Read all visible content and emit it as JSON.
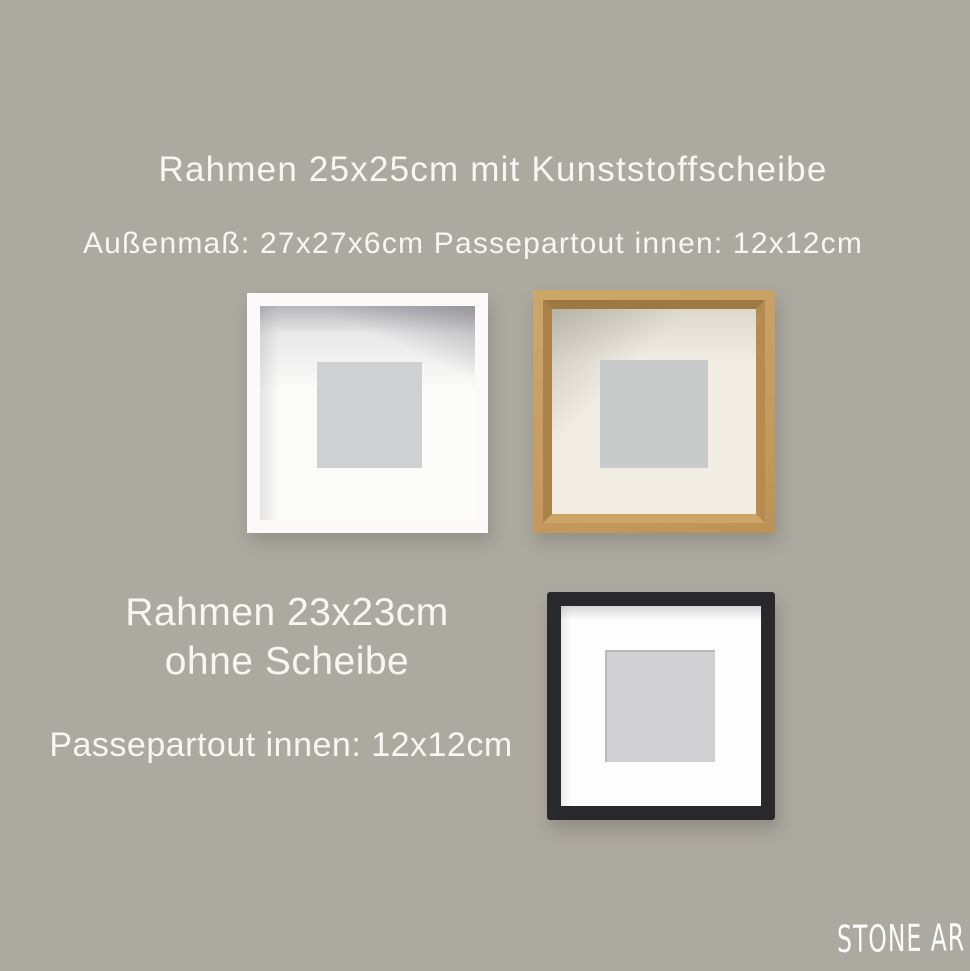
{
  "page": {
    "background_color": "#aca9a0",
    "text_color": "#f8f6f0"
  },
  "top_section": {
    "title": "Rahmen 25x25cm mit Kunststoffscheibe",
    "subtitle": "Außenmaß: 27x27x6cm Passepartout innen: 12x12cm"
  },
  "bottom_section": {
    "title_line1": "Rahmen 23x23cm",
    "title_line2": "ohne Scheibe",
    "subtitle": "Passepartout innen: 12x12cm"
  },
  "frames": {
    "white": {
      "frame_color": "#fbfaf9",
      "mat_color": "#fcfcfb",
      "opening_color": "#cfd0d2"
    },
    "oak": {
      "frame_color": "#c69c60",
      "bevel_color": "#9d7941",
      "mat_color": "#f1ede2",
      "opening_color": "#c9cbca"
    },
    "black": {
      "frame_color": "#29282b",
      "mat_color": "#fdfdfd",
      "opening_color": "#d0d0d2"
    }
  },
  "watermark": {
    "text": "STONE AR",
    "color": "#ffffff"
  }
}
